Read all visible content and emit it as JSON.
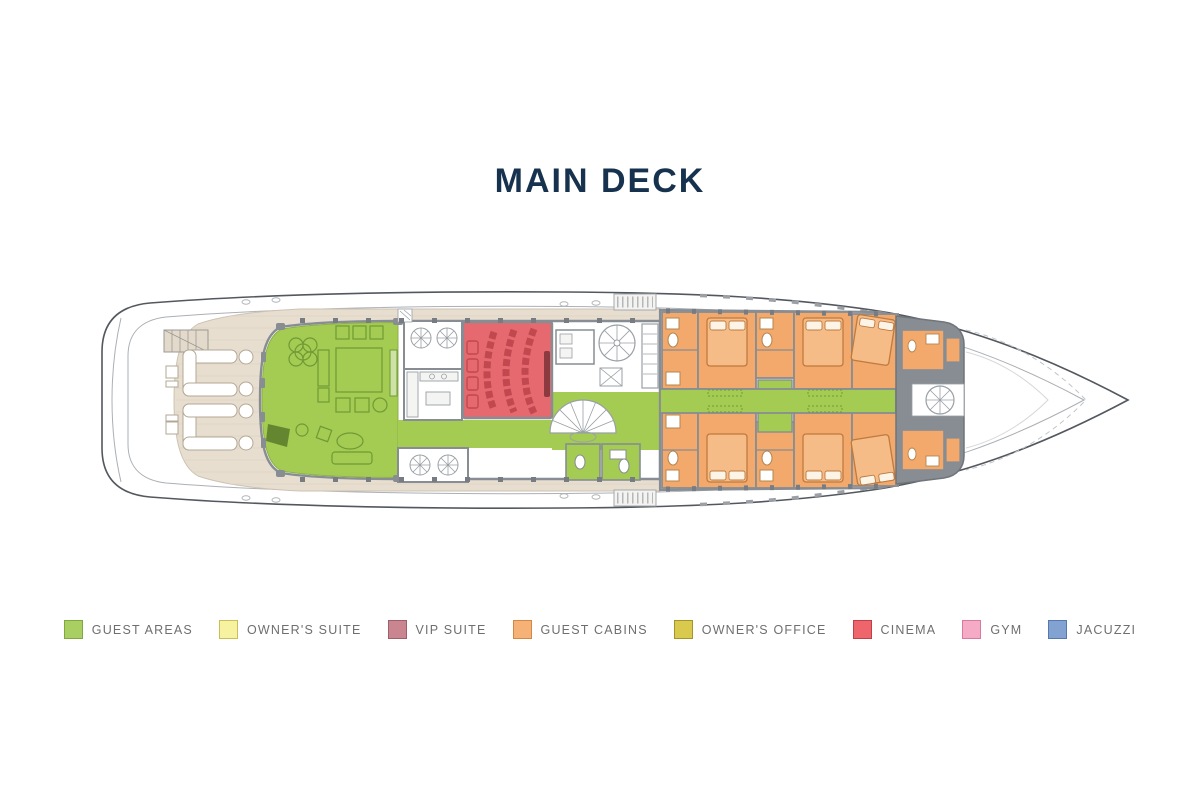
{
  "header": {
    "title": "MAIN DECK",
    "color": "#16324e"
  },
  "plan": {
    "label": "Yacht main deck floor plan",
    "areas": {
      "guest_areas": "#a4cb52",
      "guest_cabins": "#f2a96b",
      "cinema": "#e5696e",
      "deck": "#e8ded0",
      "walls": "#878d93",
      "hull": "#53585e",
      "furniture_green": "#6f9a35",
      "furniture_deck": "#b3a895",
      "cinema_seats": "#c2484f"
    }
  },
  "legend": {
    "label_color": "#6f6f6f",
    "items": [
      {
        "label": "GUEST AREAS",
        "color": "#a9cf62",
        "border": "#7fa83f"
      },
      {
        "label": "OWNER'S SUITE",
        "color": "#f7f2a0",
        "border": "#c8bf5a"
      },
      {
        "label": "VIP SUITE",
        "color": "#c98691",
        "border": "#9e5f6b"
      },
      {
        "label": "GUEST CABINS",
        "color": "#f6b176",
        "border": "#d28746"
      },
      {
        "label": "OWNER'S OFFICE",
        "color": "#d9ca4e",
        "border": "#a3952c"
      },
      {
        "label": "CINEMA",
        "color": "#ee666c",
        "border": "#bf4046"
      },
      {
        "label": "GYM",
        "color": "#f5abc6",
        "border": "#d9799f"
      },
      {
        "label": "JACUZZI",
        "color": "#82a3d1",
        "border": "#5579ae"
      }
    ]
  }
}
